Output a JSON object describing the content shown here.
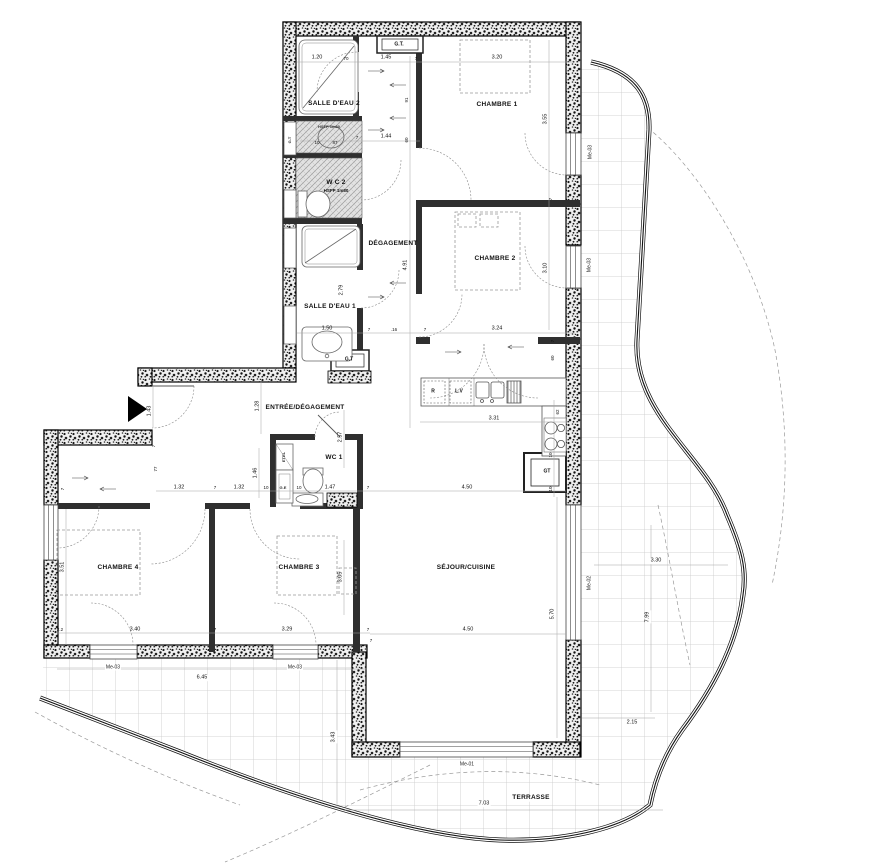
{
  "rooms": [
    "SALLE D'EAU 2",
    "CHAMBRE 1",
    "W C 2",
    "DÉGAGEMENT",
    "CHAMBRE 2",
    "SALLE D'EAU 1",
    "ENTRÉE/DÉGAGEMENT",
    "WC 1",
    "CHAMBRE 4",
    "CHAMBRE 3",
    "SÉJOUR/CUISINE",
    "TERRASSE"
  ],
  "notes": {
    "wc2_ceiling": "HSFP 1m80",
    "duct_box": "HSFP 1m80"
  },
  "equipment": [
    "G.T.",
    "G.T",
    "GT",
    "R",
    "L.V",
    "ETEL",
    "G.E",
    "G.T"
  ],
  "windows": [
    "Me-03",
    "Me-03",
    "Me-02",
    "Me-01",
    "Me-03",
    "Me-03"
  ],
  "dims": [
    "1.20",
    "70",
    "1.45",
    "7",
    "3.20",
    "91",
    "7",
    "1.44",
    "60",
    "3.55",
    "7",
    "3.10",
    "4.91",
    "2.79",
    "1.50",
    "7",
    ".16",
    "7",
    "3.24",
    "7",
    "60",
    "1.43",
    "1.28",
    "2.57",
    "1.46",
    "1.32",
    "7",
    "1.32",
    "10",
    "10",
    "1.47",
    "7",
    "4.50",
    "62",
    "10",
    "10",
    "3.31",
    "3.51",
    "3.05",
    "2.2",
    "3.40",
    "7",
    "3.29",
    "7",
    "6.45",
    "5.70",
    "4.50",
    "7",
    "3.30",
    "7.99",
    "2.15",
    "3.43",
    "7.03",
    "7",
    "77",
    "7",
    "10",
    "87"
  ]
}
